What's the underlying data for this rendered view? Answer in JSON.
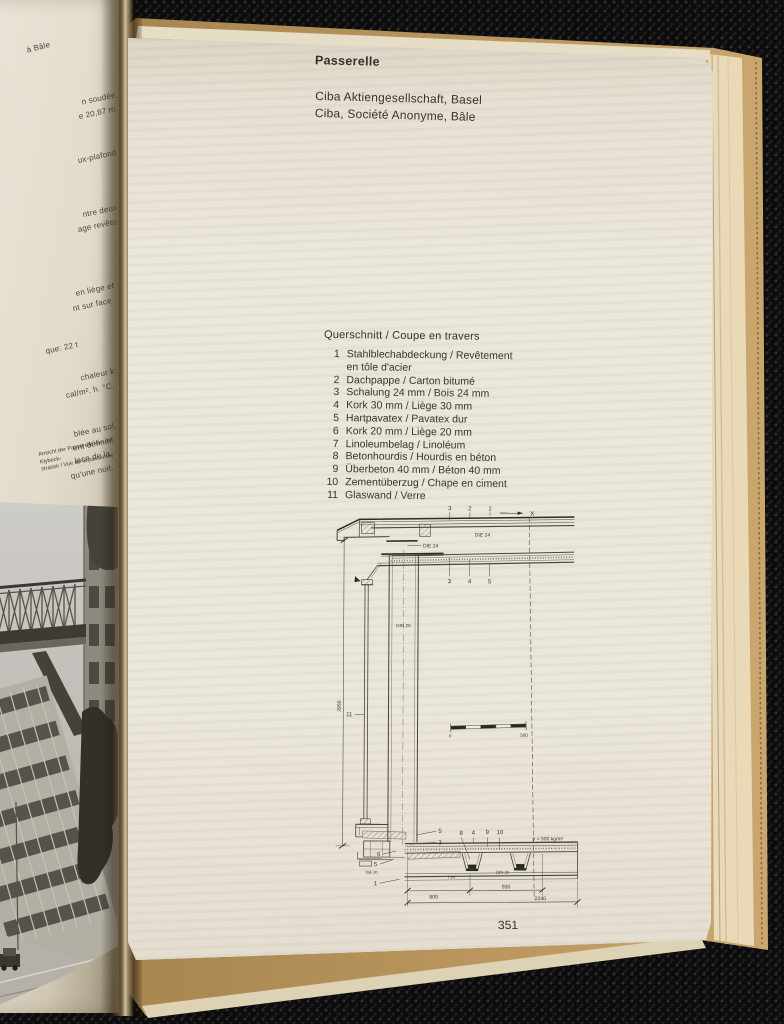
{
  "book": {
    "left_page": {
      "fragments": [
        "à Bâle",
        "n soudée,",
        "e 20,87 m.",
        "ux-plafond",
        "ntre deux",
        "age revêtu",
        "en liège et",
        "nt sur face",
        "que:  22 t",
        "chaleur k:",
        "cal/m². h. °C.",
        "blée au sol,",
        "ent définitif.",
        "lace de la",
        "qu'une nuit."
      ],
      "photo_caption_line1": "Ansicht der Passerelle von der Klybeck-",
      "photo_caption_line2": "strasse / Vue de la passerelle"
    },
    "right_page": {
      "title": "Passerelle",
      "subtitle_de": "Ciba Aktiengesellschaft, Basel",
      "subtitle_fr": "Ciba, Société Anonyme, Bâle",
      "legend_title": "Querschnitt / Coupe en travers",
      "legend_rows": [
        {
          "n": "1",
          "t": "Stahlblechabdeckung / Revêtement"
        },
        {
          "n": "",
          "t": "en tôle d'acier"
        },
        {
          "n": "2",
          "t": "Dachpappe / Carton bitumé"
        },
        {
          "n": "3",
          "t": "Schalung 24 mm / Bois 24 mm"
        },
        {
          "n": "4",
          "t": "Kork 30 mm / Liège 30 mm"
        },
        {
          "n": "5",
          "t": "Hartpavatex / Pavatex dur"
        },
        {
          "n": "6",
          "t": "Kork 20 mm / Liège 20 mm"
        },
        {
          "n": "7",
          "t": "Linoleumbelag / Linoléum"
        },
        {
          "n": "8",
          "t": "Betonhourdis / Hourdis en béton"
        },
        {
          "n": "9",
          "t": "Überbeton 40 mm / Béton 40 mm"
        },
        {
          "n": "10",
          "t": "Zementüberzug / Chape en ciment"
        },
        {
          "n": "11",
          "t": "Glaswand / Verre"
        }
      ],
      "drawing": {
        "roof_callouts": [
          "3",
          "2",
          "1"
        ],
        "section_mark": "X",
        "beam_span_label": "DIE 24",
        "beam_edge_label": "DIE 24",
        "ceiling_callouts": [
          "3",
          "4",
          "5"
        ],
        "column_label": "DIN 20",
        "glass_callout": "11",
        "height_dim": "2950",
        "scale_zero": "0",
        "scale_max": "500",
        "floor_top_callouts": [
          "8",
          "4",
          "9",
          "10"
        ],
        "load_label": "p = 500 kg/m²",
        "left_callouts": [
          "5",
          "3",
          "6",
          "5",
          "1"
        ],
        "edge_profile_label": "DIE 30",
        "steel_profile_label": "I 14",
        "joist_label": "DIN 20",
        "dim_a": "600",
        "dim_b": "930",
        "dim_total": "2240"
      },
      "page_number": "351"
    }
  },
  "colors": {
    "paper": "#e9e3d5",
    "cover_tan": "#b8935c",
    "background": "#0c0c0c",
    "ink": "#3a362f"
  }
}
